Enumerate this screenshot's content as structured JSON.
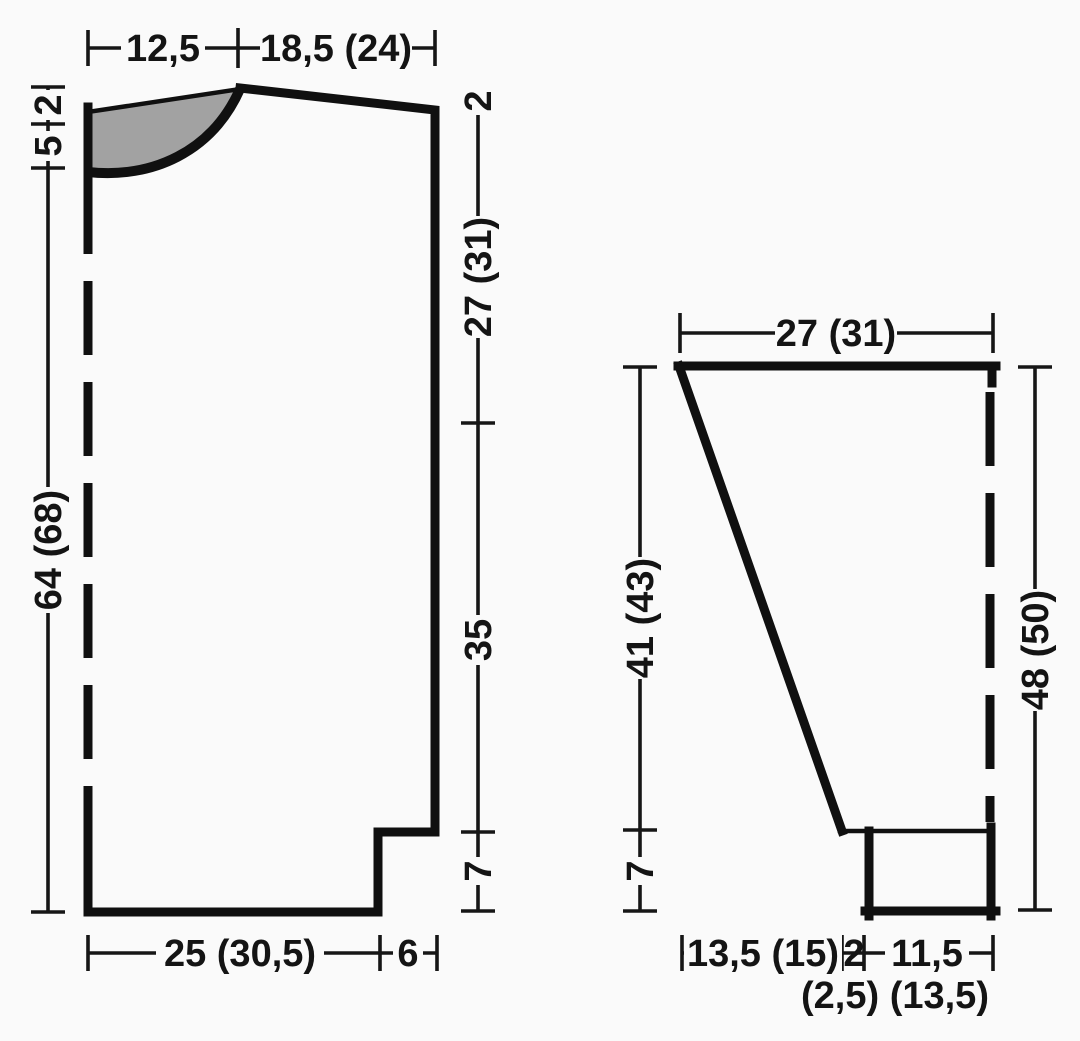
{
  "page": {
    "description": "Knitting pattern schematic with two garment pieces and centimetre measurements",
    "colors": {
      "background": "#fafafa",
      "ink": "#141414",
      "neck_inset_fill": "#a2a2a2"
    }
  },
  "body_piece": {
    "top_neck_width": "12,5",
    "top_shoulder_width": "18,5 (24)",
    "left_back_neck_depth": "2",
    "left_front_neck_depth": "5",
    "left_total_length": "64 (68)",
    "right_shoulder_drop": "2",
    "right_armhole_depth": "27 (31)",
    "right_side_length": "35",
    "right_rib_height": "7",
    "bottom_main_width": "25 (30,5)",
    "bottom_extension_width": "6"
  },
  "sleeve_piece": {
    "top_width": "27 (31)",
    "left_upper_length": "41 (43)",
    "left_rib_height": "7",
    "right_total_length": "48 (50)",
    "bottom_slant_width": "13,5 (15)",
    "bottom_step_width": "2",
    "bottom_cuff_width": "11,5",
    "bottom_second_sizes": "(2,5) (13,5)"
  }
}
